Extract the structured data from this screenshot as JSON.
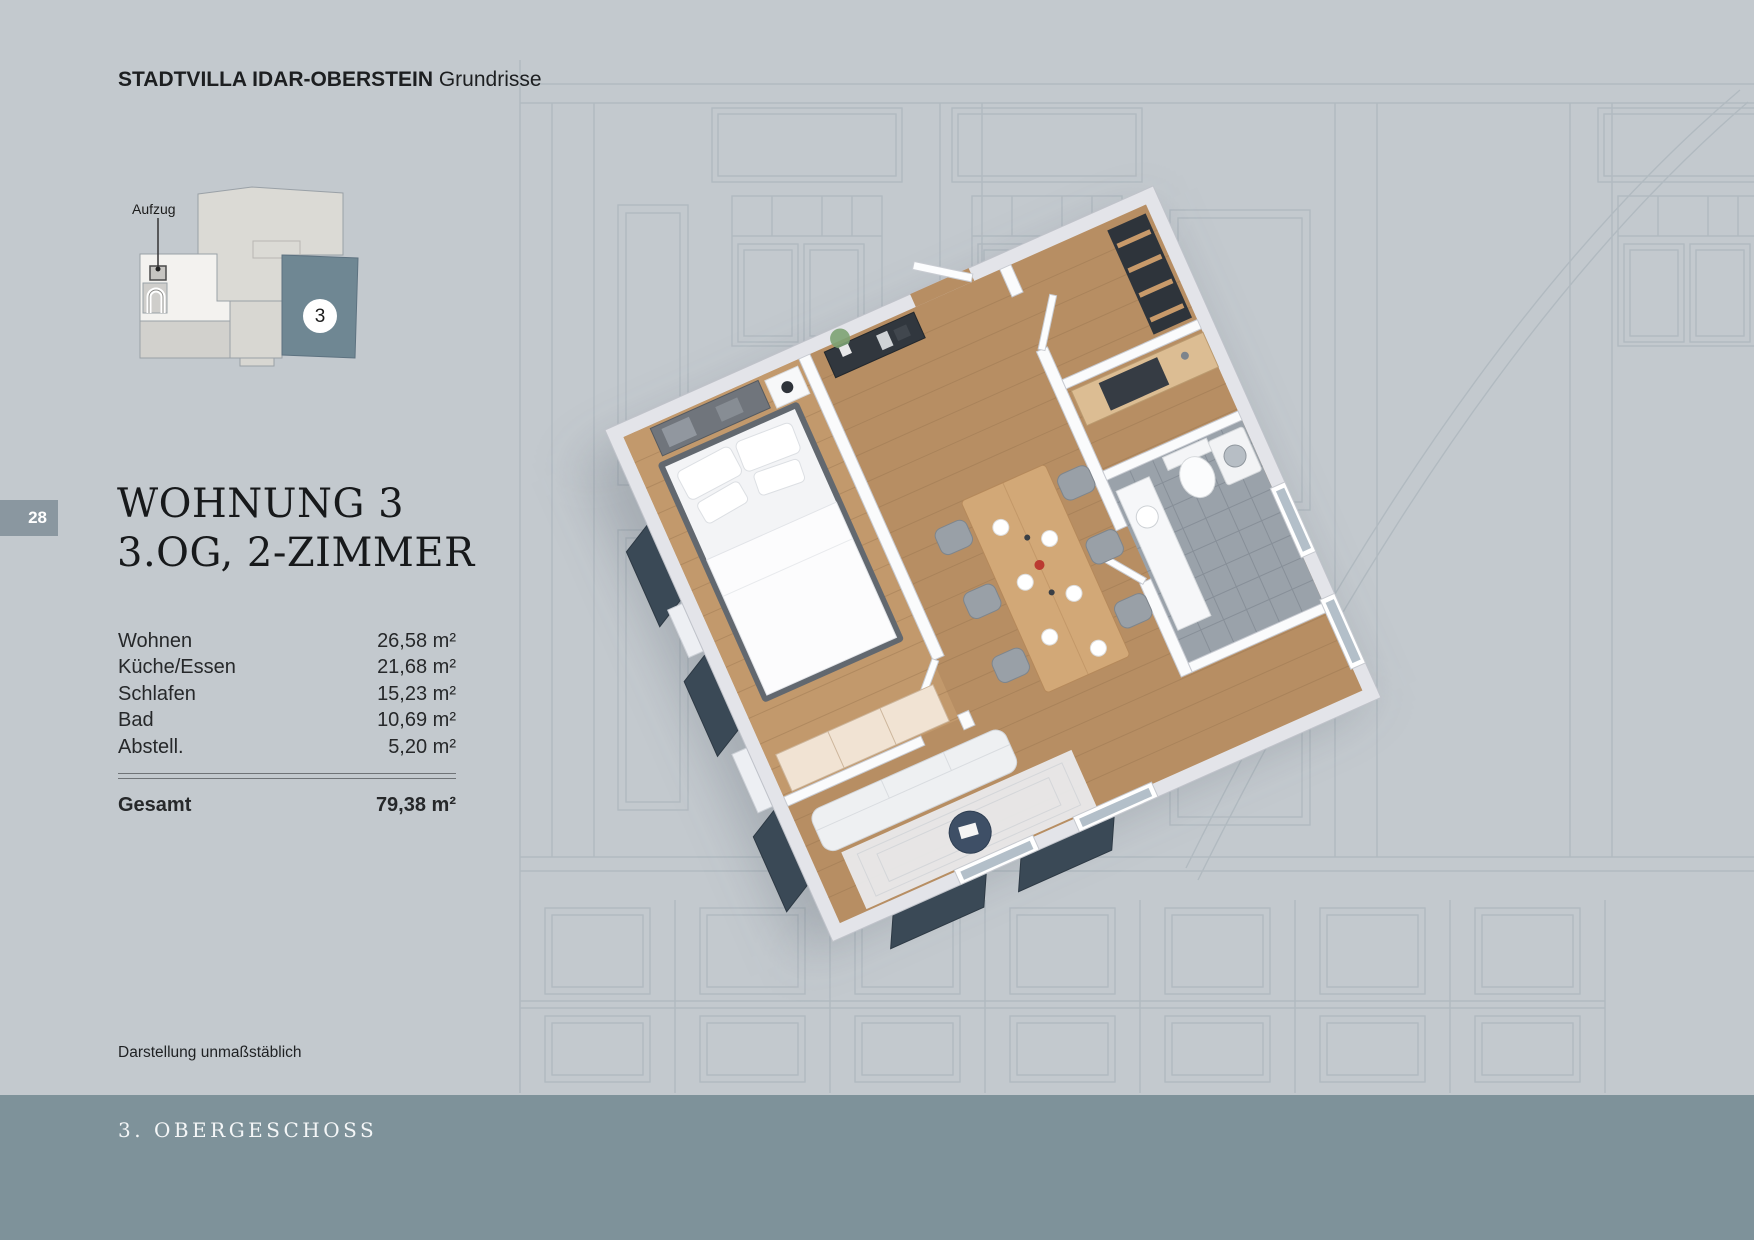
{
  "header": {
    "brand": "STADTVILLA IDAR-OBERSTEIN",
    "section": "Grundrisse"
  },
  "locator": {
    "elevator_label": "Aufzug",
    "unit_badge": "3"
  },
  "page_tab": {
    "number": "28"
  },
  "listing": {
    "title_line1": "WOHNUNG 3",
    "title_line2": "3.OG, 2-ZIMMER",
    "areas": [
      {
        "label": "Wohnen",
        "value": "26,58 m²"
      },
      {
        "label": "Küche/Essen",
        "value": "21,68 m²"
      },
      {
        "label": "Schlafen",
        "value": "15,23 m²"
      },
      {
        "label": "Bad",
        "value": "10,69 m²"
      },
      {
        "label": "Abstell.",
        "value": "5,20 m²"
      }
    ],
    "total": {
      "label": "Gesamt",
      "value": "79,38 m²"
    }
  },
  "footnote": "Darstellung unmaßstäblich",
  "footer": {
    "label": "3. OBERGESCHOSS"
  },
  "colors": {
    "page_background": "#c3c9ce",
    "footer_bar": "#7e929a",
    "page_tab": "#8a97a0",
    "unit_highlight": "#6f8793",
    "roof_panel_dark": "#3a4956",
    "wood_floor": "#b78e63",
    "facade_line": "#a7b1b9"
  }
}
